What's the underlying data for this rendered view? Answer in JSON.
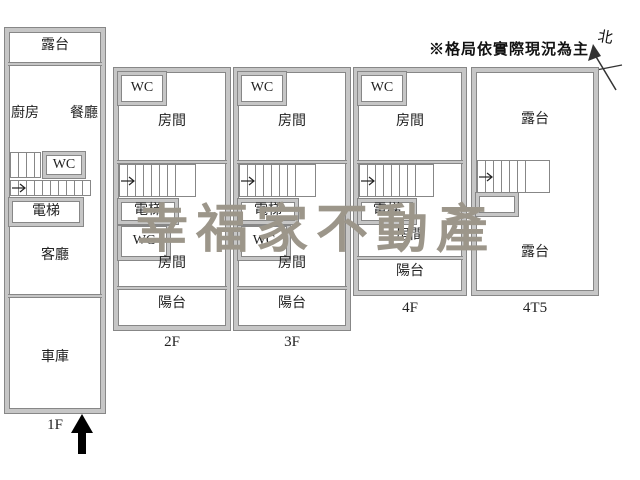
{
  "disclaimer": "※格局依實際現況為主",
  "north_label": "北",
  "watermark": "幸福家不動產",
  "colors": {
    "wall_fill": "#c6c6c6",
    "wall_edge": "#878787",
    "watermark": "#9c968a",
    "text": "#222222",
    "arrow": "#000000"
  },
  "floors": {
    "f1": {
      "label": "1F",
      "terrace": "露台",
      "kitchen": "廚房",
      "dining": "餐廳",
      "wc": "WC",
      "elevator": "電梯",
      "living": "客廳",
      "garage": "車庫"
    },
    "f2": {
      "label": "2F",
      "wc_top": "WC",
      "room_top": "房間",
      "elevator": "電梯",
      "wc_mid": "WC",
      "room_mid": "房間",
      "balcony": "陽台"
    },
    "f3": {
      "label": "3F",
      "wc_top": "WC",
      "room_top": "房間",
      "elevator": "電梯",
      "wc_mid": "WC",
      "room_mid": "房間",
      "balcony": "陽台"
    },
    "f4": {
      "label": "4F",
      "wc_top": "WC",
      "room_top": "房間",
      "elevator": "電梯",
      "room_mid": "房間",
      "balcony": "陽台"
    },
    "f4t5": {
      "label": "4T5",
      "terrace_top": "露台",
      "terrace_bottom": "露台"
    }
  }
}
